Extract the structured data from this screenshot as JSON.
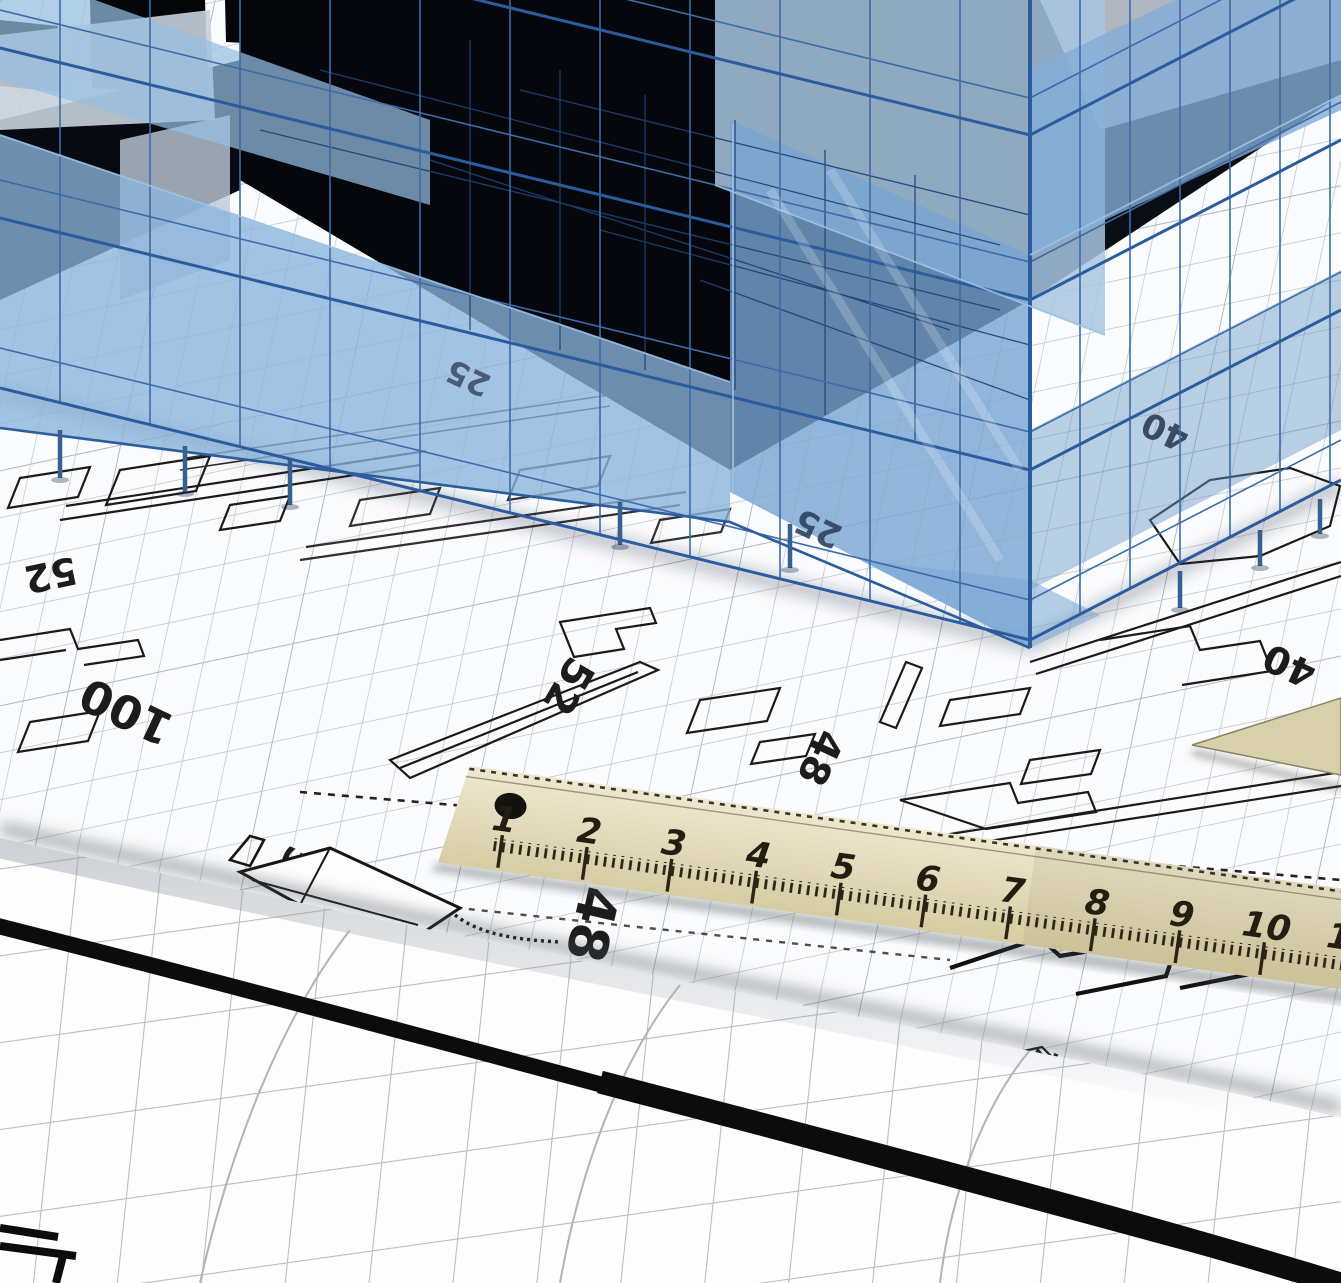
{
  "scene": {
    "title": "3D wireframe building on architectural blueprints",
    "description": "Translucent blue 3D wireframe building model standing over rolled blueprint grid sheets with black floor-plan linework, dimension figures, a drafting pen shape and a wooden ruler."
  },
  "colors": {
    "paper_white": "#fafbfc",
    "grid_gray": "#c3c7cd",
    "plan_line_black": "#1a1a1a",
    "heavy_line_black": "#0c0c0c",
    "wireframe_blue": "#2b5c9e",
    "wireframe_blue_dark": "#1c4276",
    "wireframe_highlight": "#8fb6dc",
    "glass_blue": "#7da7d0",
    "glass_pale": "#a9c3de",
    "building_void": "#05070c",
    "ruler_wood_light": "#eee7cf",
    "ruler_wood_dark": "#d9d0aa",
    "ruler_marking": "#2b2416"
  },
  "blueprint": {
    "dimensions": {
      "d52_left": "52",
      "d100": "100",
      "d52_mid": "52",
      "d48_mid": "48",
      "d40_upper": "40",
      "d40_right": "40",
      "d25_upper": "25",
      "d25_lower": "25",
      "d5_left": "5",
      "d48_lower": "48",
      "d7_right": "7"
    }
  },
  "ruler": {
    "unit_marks": [
      "1",
      "2",
      "3",
      "4",
      "5",
      "6",
      "7",
      "8",
      "9",
      "10",
      "11"
    ]
  }
}
